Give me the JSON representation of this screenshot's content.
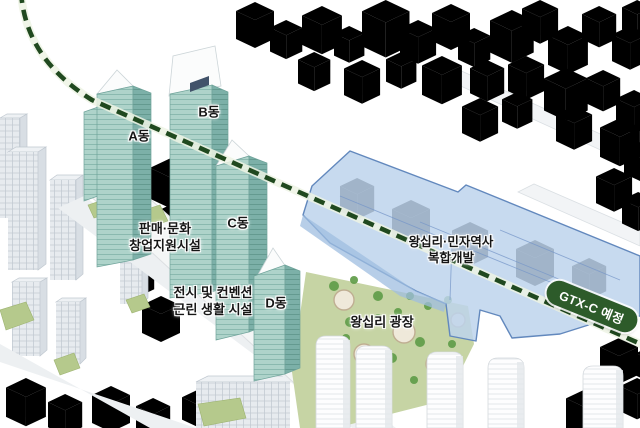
{
  "labels": {
    "building_a": "A동",
    "building_b": "B동",
    "building_c": "C동",
    "building_d": "D동",
    "retail": {
      "line1": "판매·문화",
      "line2": "창업지원시설"
    },
    "exhibition": {
      "line1": "전시 및 컨벤션",
      "line2": "근린 생활 시설"
    },
    "plaza": "왕십리 광장",
    "station": {
      "line1": "왕십리·민자역사",
      "line2": "복합개발"
    },
    "gtx_badge": "GTX-C 예정"
  },
  "colors": {
    "tower_teal_light": "#aed3ca",
    "tower_teal_dark": "#7cb0a8",
    "overlay_blue": "#bdd3ec",
    "overlay_blue_border": "#6288bd",
    "overlay_blue_side": "#9fbde0",
    "route_green": "#20491f",
    "badge_green": "#2d5b2a",
    "ground_green": "#b5c98c",
    "tree_green": "#5f9c49",
    "lawn_olive": "#c6d4a4"
  }
}
